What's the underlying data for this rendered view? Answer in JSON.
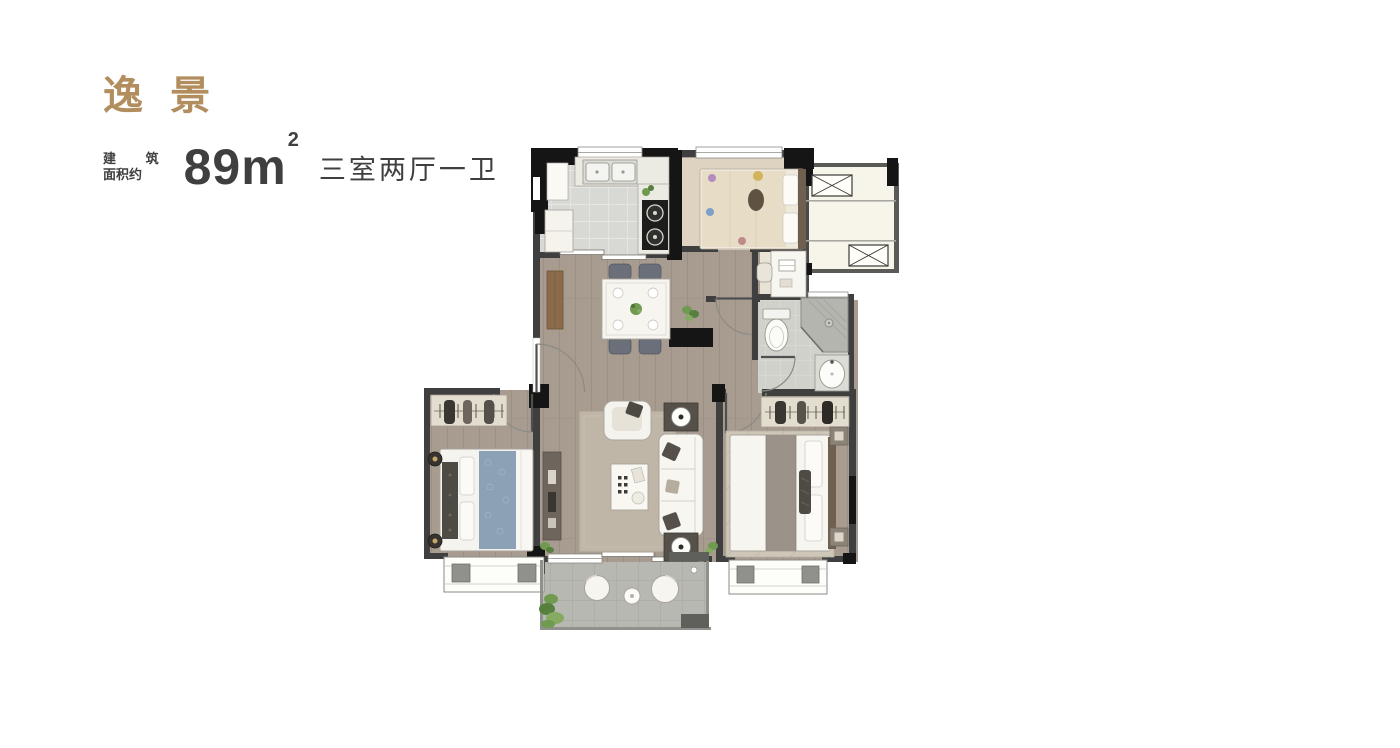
{
  "header": {
    "title": "逸 景",
    "area_label_line1": "建 筑",
    "area_label_line2": "面积约",
    "area_value": "89m",
    "area_superscript": "2",
    "layout_spec": "三室两厅一卫"
  },
  "colors": {
    "title": "#b28e5f",
    "body_text": "#3f3f3f",
    "wall": "#3f3f3f",
    "column": "#151515",
    "wood_floor": "#a89c90",
    "bedroom3_floor": "#ded3c1",
    "kitchen_tile": "#d8d8d4",
    "bathroom_tile": "#d1d1cc",
    "balcony_tile": "#b7b8b1",
    "platform_floor": "#f7f4ea",
    "bed_blue": "#8ca1b6",
    "sideboard_wood": "#8b6b49",
    "plant_green": "#6f9a4f"
  }
}
